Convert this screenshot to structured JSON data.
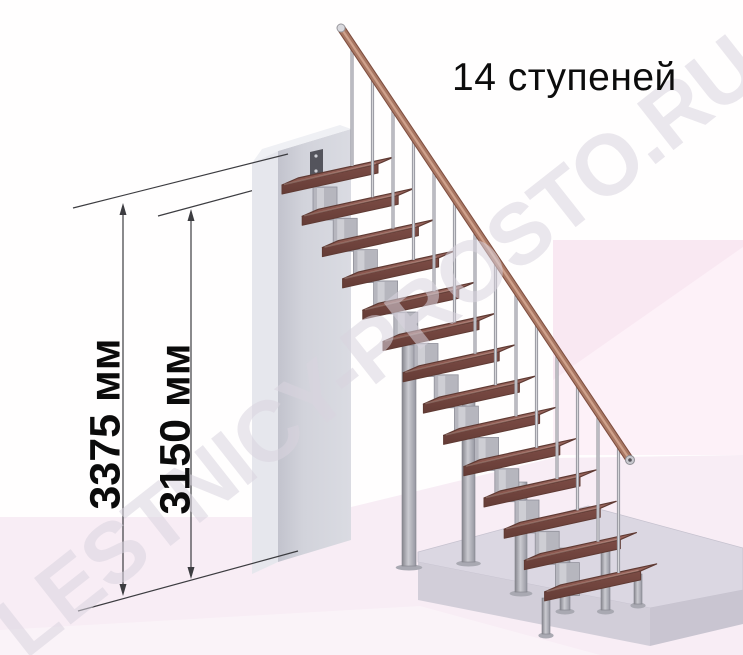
{
  "title": "14 ступеней",
  "watermark": "LESTNICY-PROSTO.RU",
  "dimension_labels": {
    "outer": "3375 мм",
    "inner": "3150 мм"
  },
  "stairs": {
    "step_count": 14,
    "unit": "мм",
    "total_height": 3375,
    "height_to_second_step": 3150
  },
  "colors": {
    "tread_top_light": "#9a665e",
    "tread_top_dark": "#855249",
    "tread_front_light": "#7c4c45",
    "tread_front_dark": "#653c36",
    "tread_outline": "#5f3a33",
    "rail": "#a87763",
    "rail_highlight": "#cfa18c",
    "rail_shadow": "#7d4c3e",
    "metal": "#b6b6be",
    "metal_dark": "#90909a",
    "baluster": "#9b9ba3",
    "baluster_core": "#d6d6da",
    "wall_front": "#d2d3db",
    "wall_side": "#e6e7ed",
    "wall_top": "#eff0f4",
    "wall_shade": "#c2c3cd",
    "bracket": "#54545c",
    "slab_top": "#dbd7e2",
    "slab_front": "#d2ced9",
    "slab_right": "#c9c5d1",
    "floor_pink": "#f8edf5",
    "panel_pink": "#f9e8f2",
    "panel_pink_light": "#fdf1f8",
    "dimension_line": "#3c3c40"
  }
}
